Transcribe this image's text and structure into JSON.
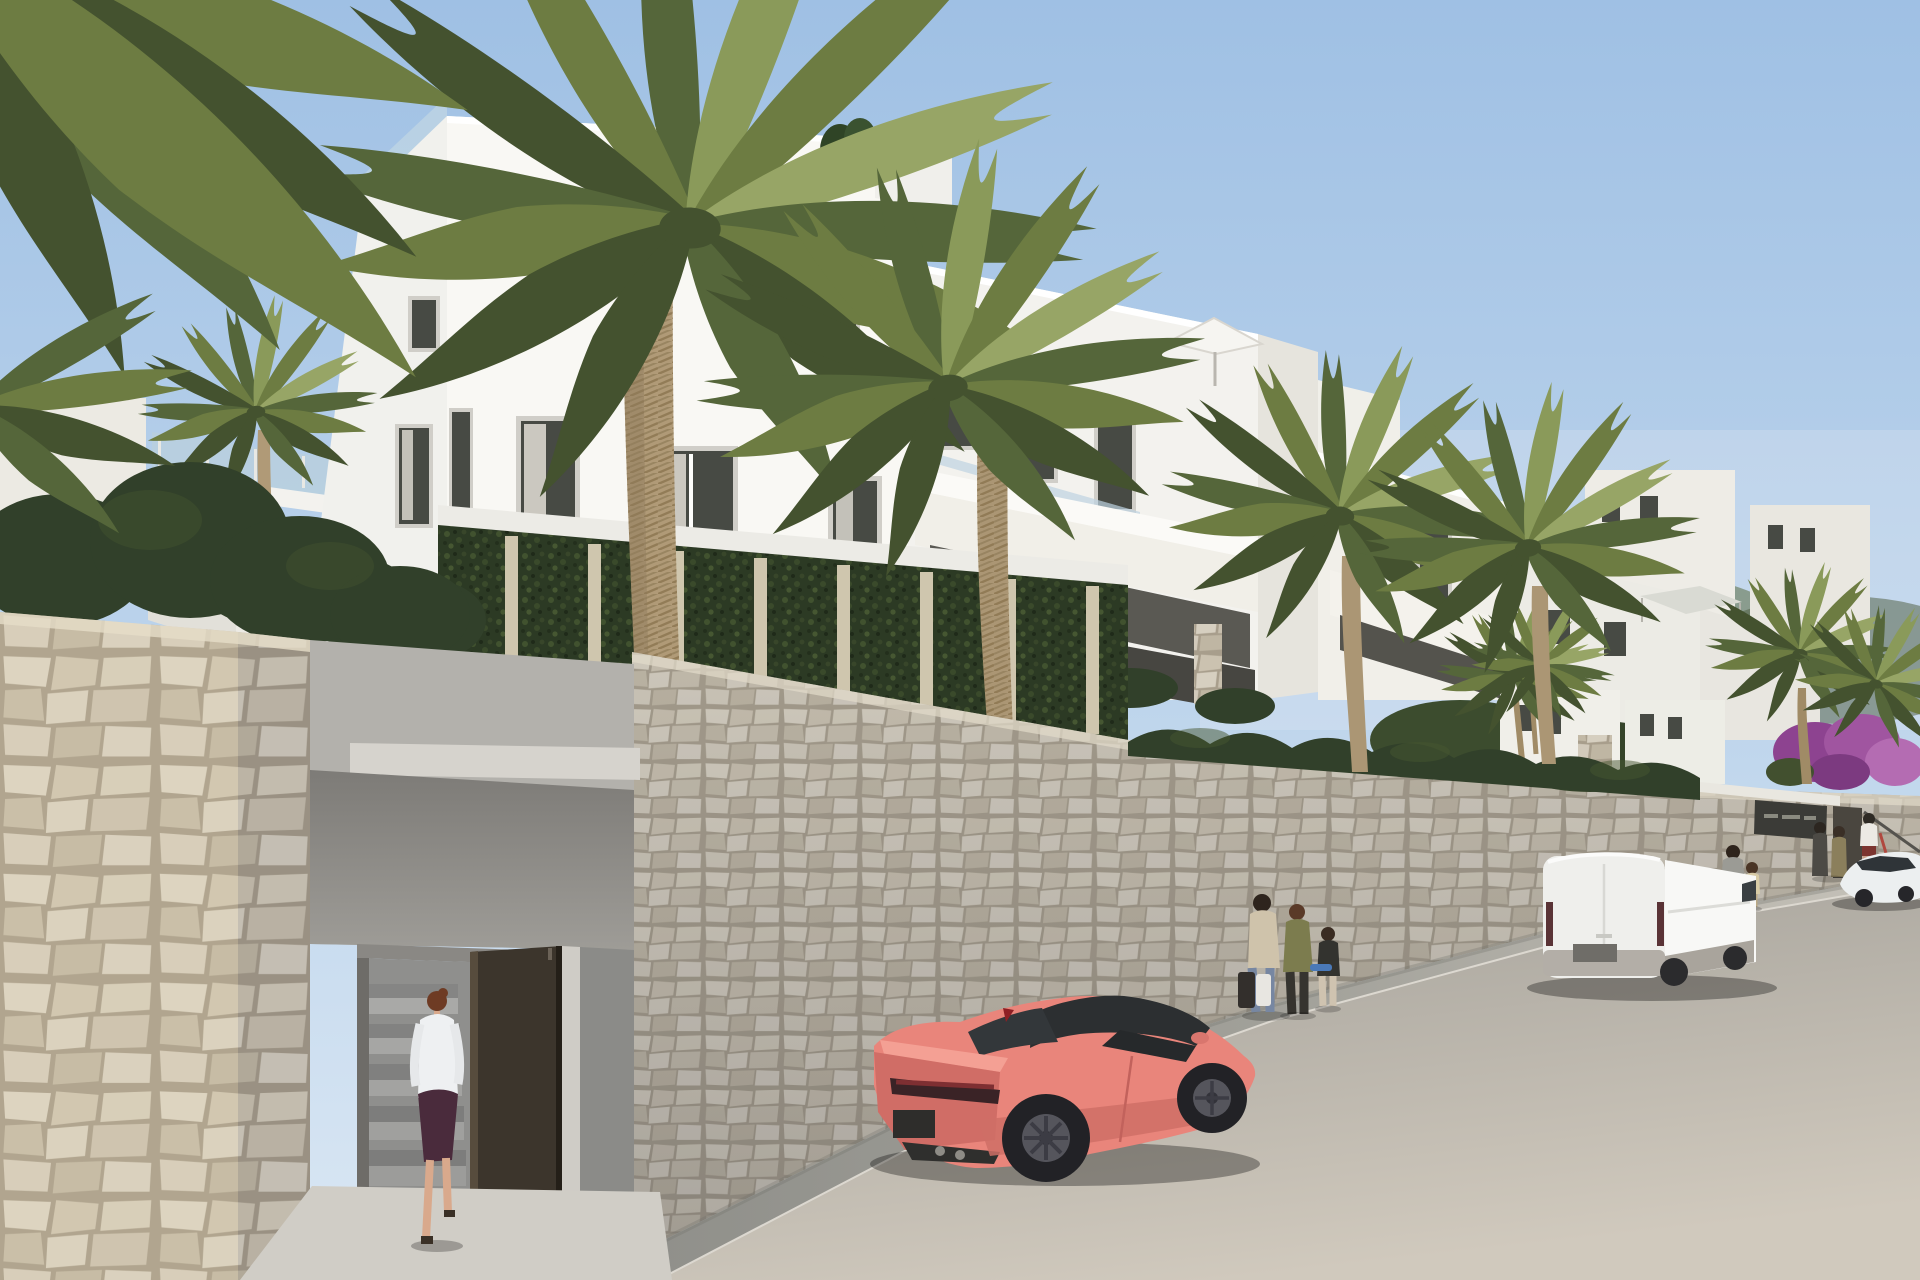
{
  "meta": {
    "title": "Modern apartment development - exterior street rendering",
    "description": "Photorealistic 3D architectural rendering of a white Mediterranean apartment complex on a hillside street: natural stone retaining walls, fan palm trees, landscaped gardens with lawn and wildflowers, an underground entrance with an open brown door, pedestrians on the sidewalk, a coral sports coupe, a white cargo van and a white sedan parked along the road under a clear blue sky.",
    "media_type": "3d-architectural-visualization"
  },
  "palette": {
    "sky_top": "#a1c1e5",
    "sky_horizon": "#d8e6f3",
    "building_white_sunlit": "#f8f7f3",
    "building_white_shaded": "#e9e7e1",
    "window_glass": "#474a44",
    "glass_railing": "#bed3e1",
    "stone_light": "#d8d1c2",
    "stone_joint": "#a89e8c",
    "hedge_green": "#31402a",
    "ivy_green": "#2c3a24",
    "palm_green": "#6d7c42",
    "palm_trunk": "#b09a77",
    "grass_green": "#74883f",
    "wildflower_yellow": "#ddc94f",
    "sidewalk_gray": "#96968f",
    "road_gray": "#b0aca6",
    "car_coral": "#e9857b",
    "van_white": "#f4f4f1",
    "sedan_white": "#eceff0",
    "door_brown": "#3c352c",
    "bougainvillea_purple": "#a055a0",
    "concrete_gray": "#b3b1ac"
  },
  "scene": {
    "sky": {
      "description": "clear blue sky, brighter toward the horizon"
    },
    "buildings": {
      "description": "terraced white apartment blocks stepping downhill to the right",
      "features": [
        "roof terraces with glass balustrades",
        "recessed windows with curtains",
        "white balcony parapets",
        "white roof parasol",
        "gray shade sail",
        "stone-clad pillar accents",
        "ivy-covered garden walls"
      ]
    },
    "vegetation": {
      "foreground_palms": 2,
      "midground_palms": 4,
      "other": [
        "clipped hedges",
        "sloped lawn with yellow wildflowers",
        "purple bougainvillea",
        "ivy walls with stone pillars"
      ]
    },
    "street": {
      "elements": [
        "long natural-stone retaining wall",
        "stone boundary wall",
        "underground entrance with open brown door and staircase",
        "shaded sidewalk",
        "asphalt road sloping downhill"
      ],
      "signage": {
        "entrance_plaque": {
          "legible": false,
          "color": "#3b3b37"
        }
      }
    },
    "vehicles": [
      {
        "type": "sports coupe",
        "color": "coral pink",
        "state": "parked facing uphill"
      },
      {
        "type": "cargo van",
        "color": "white",
        "state": "parked on the right side"
      },
      {
        "type": "sedan",
        "color": "white",
        "state": "parked far right"
      },
      {
        "type": "kick scooter",
        "color": "red",
        "state": "held by a pedestrian"
      }
    ],
    "people": [
      {
        "label": "woman entering gate",
        "clothing": "white shirt, dark plum skirt"
      },
      {
        "label": "woman with shopping bags"
      },
      {
        "label": "teenager in olive jacket"
      },
      {
        "label": "child with skateboard"
      },
      {
        "label": "man walking with child"
      },
      {
        "label": "couple talking near far entrance"
      },
      {
        "label": "man with red scooter"
      }
    ]
  }
}
